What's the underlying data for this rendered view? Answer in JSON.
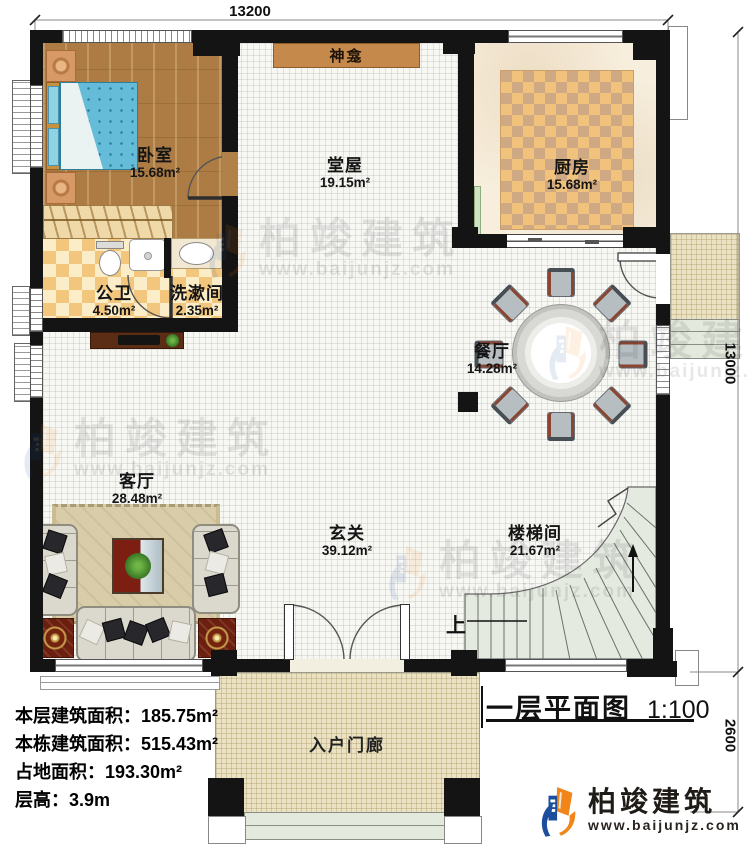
{
  "dimensions": {
    "top_width": "13200",
    "right_height": "13000",
    "porch_height": "2600"
  },
  "rooms": {
    "bedroom": {
      "name": "卧室",
      "area": "15.68m²"
    },
    "shrine": {
      "name": "神龛"
    },
    "main_hall": {
      "name": "堂屋",
      "area": "19.15m²"
    },
    "kitchen": {
      "name": "厨房",
      "area": "15.68m²"
    },
    "public_bath": {
      "name": "公卫",
      "area": "4.50m²"
    },
    "washroom": {
      "name": "洗漱间",
      "area": "2.35m²"
    },
    "dining": {
      "name": "餐厅",
      "area": "14.28m²"
    },
    "living": {
      "name": "客厅",
      "area": "28.48m²"
    },
    "foyer": {
      "name": "玄关",
      "area": "39.12m²"
    },
    "stairwell": {
      "name": "楼梯间",
      "area": "21.67m²"
    },
    "entry_porch": {
      "name": "入户门廊"
    }
  },
  "stairs": {
    "up_label": "上"
  },
  "info_panel": {
    "lines": [
      {
        "label": "本层建筑面积：",
        "value": "185.75m²"
      },
      {
        "label": "本栋建筑面积：",
        "value": "515.43m²"
      },
      {
        "label": "占地面积：",
        "value": "193.30m²"
      },
      {
        "label": "层高：",
        "value": "3.9m"
      }
    ]
  },
  "title_block": {
    "title": "一层平面图",
    "scale": "1:100"
  },
  "brand": {
    "name": "柏竣建筑",
    "website": "www.baijunjz.com"
  },
  "watermark": {
    "name": "柏竣建筑",
    "website": "www.baijunjz.com"
  },
  "colors": {
    "wall": "#141414",
    "brand_blue": "#1b4f9d",
    "brand_orange": "#f08519",
    "wood": "#ad7c44",
    "tile_warm": "#f2c77d",
    "stair": "#e4eae0",
    "porch": "#ebe2c3"
  }
}
